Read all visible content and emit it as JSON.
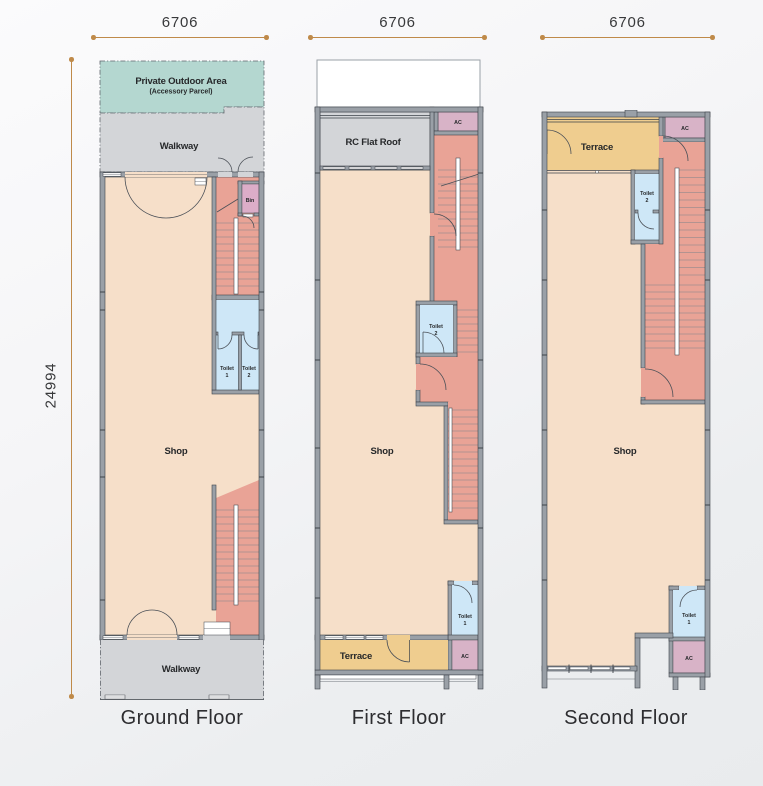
{
  "dimensions": {
    "ground_width": "6706",
    "first_width": "6706",
    "second_width": "6706",
    "ground_height": "24994"
  },
  "floors": {
    "ground": {
      "title": "Ground Floor",
      "private_outdoor_area": "Private Outdoor Area",
      "accessory_parcel": "(Accessory Parcel)",
      "walkway_top": "Walkway",
      "walkway_bottom": "Walkway",
      "bin": "Bin",
      "shop": "Shop",
      "toilet_word_1": "Toilet",
      "toilet_num_1": "1",
      "toilet_word_2": "Toilet",
      "toilet_num_2": "2"
    },
    "first": {
      "title": "First Floor",
      "rc_flat_roof": "RC Flat Roof",
      "ac_top": "AC",
      "ac_bottom": "AC",
      "shop": "Shop",
      "terrace": "Terrace",
      "toilet_word_1": "Toilet",
      "toilet_num_1": "1",
      "toilet_word_2": "Toilet",
      "toilet_num_2": "2"
    },
    "second": {
      "title": "Second Floor",
      "terrace": "Terrace",
      "ac_top": "AC",
      "ac_bottom": "AC",
      "shop": "Shop",
      "toilet_word_1": "Toilet",
      "toilet_num_1": "1",
      "toilet_word_2": "Toilet",
      "toilet_num_2": "2"
    }
  },
  "colors": {
    "outdoor_teal": "#b4d7d0",
    "walkway_gray": "#d3d5d8",
    "shop_peach": "#f6dfc9",
    "stair_salmon": "#e9a396",
    "toilet_blue": "#cee7f7",
    "ac_mauve": "#d8b3c7",
    "bin_pink": "#dcadc8",
    "terrace_yellow": "#efcd8f",
    "wall_fill": "#9aa0a7",
    "wall_line": "#3e434a",
    "dim_gold": "#bf8a49",
    "text_dark": "#26282a"
  }
}
